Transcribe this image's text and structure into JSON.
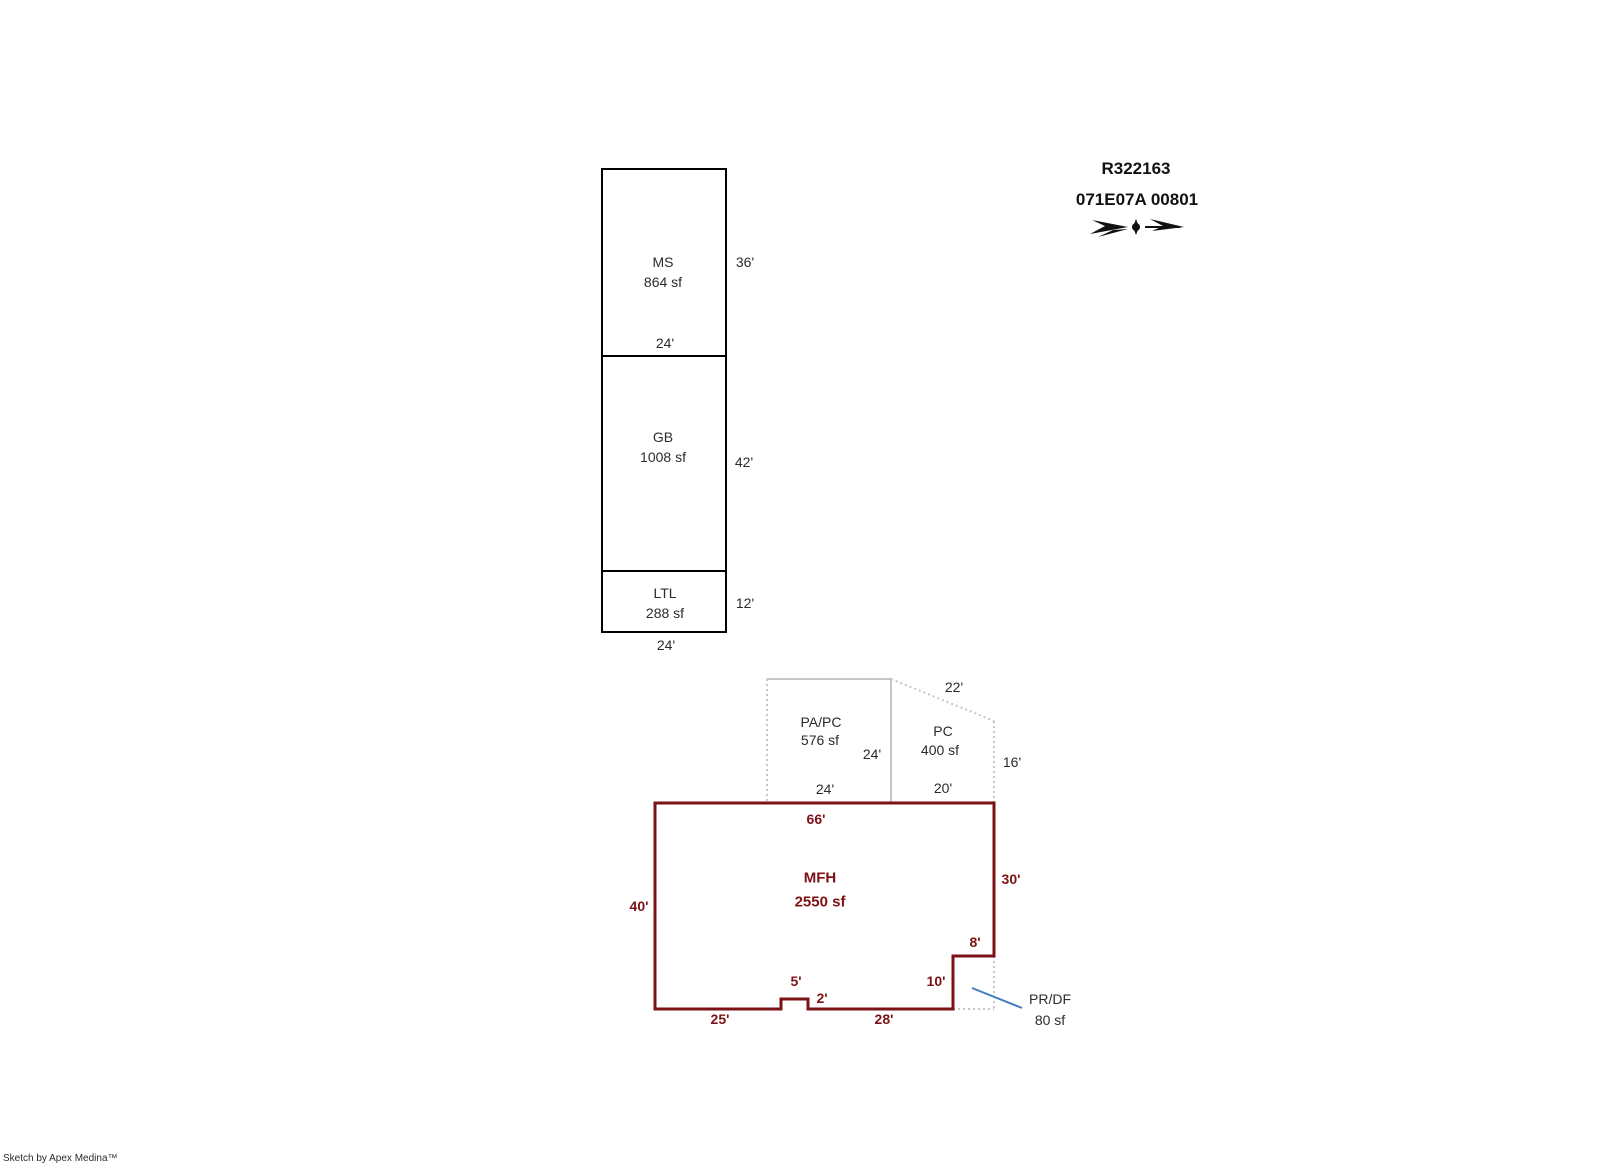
{
  "header": {
    "record_id": "R322163",
    "map_taxlot": "071E07A 00801",
    "north_arrow_icon": "north-arrow"
  },
  "footer": {
    "credit": "Sketch by Apex Medina™"
  },
  "colors": {
    "black_outline": "#000000",
    "red_outline": "#7c1216",
    "gray_outline": "#c6c6c6",
    "pointer_blue": "#4a7cc0",
    "text_dark": "#2b2b2b"
  },
  "sections": {
    "ms": {
      "name": "MS",
      "area": "864 sf",
      "width_bottom": "24'",
      "height_right": "36'"
    },
    "gb": {
      "name": "GB",
      "area": "1008 sf",
      "height_right": "42'"
    },
    "ltl": {
      "name": "LTL",
      "area": "288 sf",
      "height_right": "12'",
      "width_bottom": "24'"
    },
    "papc": {
      "name": "PA/PC",
      "area": "576 sf",
      "height_right": "24'",
      "width_bottom": "24'"
    },
    "pc": {
      "name": "PC",
      "area": "400 sf",
      "slant_top": "22'",
      "height_right": "16'",
      "width_bottom": "20'"
    },
    "mfh": {
      "name": "MFH",
      "area": "2550 sf",
      "top": "66'",
      "left": "40'",
      "right": "30'",
      "notch_width": "8'",
      "notch_height": "10'",
      "bump_width": "5'",
      "bump_height": "2'",
      "bottom_left": "25'",
      "bottom_right": "28'"
    },
    "prdf": {
      "name": "PR/DF",
      "area": "80 sf"
    }
  }
}
